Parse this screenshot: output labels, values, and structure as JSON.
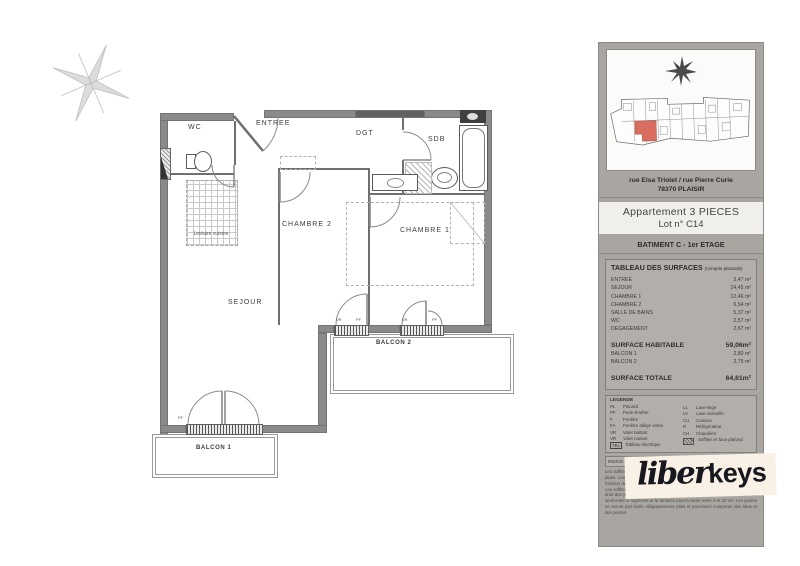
{
  "plan": {
    "rooms": {
      "wc": "WC",
      "entree": "ENTREE",
      "dgt": "DGT",
      "sdb": "SDB",
      "chambre2": "CHAMBRE 2",
      "chambre1": "CHAMBRE 1",
      "sejour": "SEJOUR",
      "balcon1": "BALCON 1",
      "balcon2": "BALCON 2"
    },
    "annotations": {
      "kitchen": "Linéaire cuisine",
      "pf": "PF",
      "vr": "VR"
    }
  },
  "panel": {
    "address_line1": "rue Elsa Triolet / rue Pierre Curie",
    "address_line2": "78370 PLAISIR",
    "apartment_line1": "Appartement  3 PIECES",
    "apartment_line2": "Lot n° C14",
    "building": "BATIMENT C - 1er ETAGE",
    "table_title": "TABLEAU DES SURFACES",
    "table_note": "(compris placards)",
    "surface_rows": [
      {
        "label": "ENTREE",
        "value": "3,47 m²"
      },
      {
        "label": "SEJOUR",
        "value": "24,45 m²"
      },
      {
        "label": "CHAMBRE 1",
        "value": "12,46 m²"
      },
      {
        "label": "CHAMBRE 2",
        "value": "9,54 m²"
      },
      {
        "label": "SALLE DE BAINS",
        "value": "5,37 m²"
      },
      {
        "label": "WC",
        "value": "2,57 m²"
      },
      {
        "label": "DEGAGEMENT",
        "value": "2,67 m²"
      }
    ],
    "habitable_label": "SURFACE HABITABLE",
    "habitable_value": "59,06m²",
    "balcony_rows": [
      {
        "label": "BALCON 1",
        "value": "2,80 m²"
      },
      {
        "label": "BALCON 2",
        "value": "2,75 m²"
      }
    ],
    "total_label": "SURFACE TOTALE",
    "total_value": "64,61m²",
    "legend_title": "LEGENDE",
    "legend_left": [
      {
        "code": "PL",
        "label": "Placard"
      },
      {
        "code": "PF",
        "label": "Porte-fenêtre"
      },
      {
        "code": "F",
        "label": "Fenêtre"
      },
      {
        "code": "FA",
        "label": "Fenêtre allège vitrée"
      },
      {
        "code": "VB",
        "label": "Volet battant"
      },
      {
        "code": "VR",
        "label": "Volet roulant"
      },
      {
        "code": "TBL",
        "label": "Tableau électrique",
        "boxed": true
      }
    ],
    "legend_right": [
      {
        "code": "LL",
        "label": "Lave-linge"
      },
      {
        "code": "LV",
        "label": "Lave-vaisselle"
      },
      {
        "code": "CU",
        "label": "Cuisson"
      },
      {
        "code": "R",
        "label": "Réfrigérateur"
      },
      {
        "code": "CH",
        "label": "Chaudière"
      },
      {
        "code": "",
        "label": "Soffites et faux-plafond",
        "swatch": true
      }
    ],
    "indice_cells": [
      "INDICE :",
      "Nature",
      "DATE",
      ""
    ],
    "disclaimer_lines": [
      "Les soffites et retombées ne sont pas représentés de façon exhaustive sur les plans. Les côtes et surfaces sont données à titre indicatif et pourront varier en fonction des impératifs techniques.",
      "Les soffites de volet roulant ne sont pas représentés. La hauteur des seuils au droit des porte-fenêtres pourra varier de 1 à 10 cm à partir du sol intérieur. Le seuil entre le logement et la terrasse pourra varier entre 0 et 10 cm. Les jardins ne seront pas livrés obligatoirement plats et pourraient comporter des talus et des pentes."
    ],
    "logo_part1": "liber",
    "logo_part2": "keys",
    "highlight_color": "#d96e60"
  }
}
